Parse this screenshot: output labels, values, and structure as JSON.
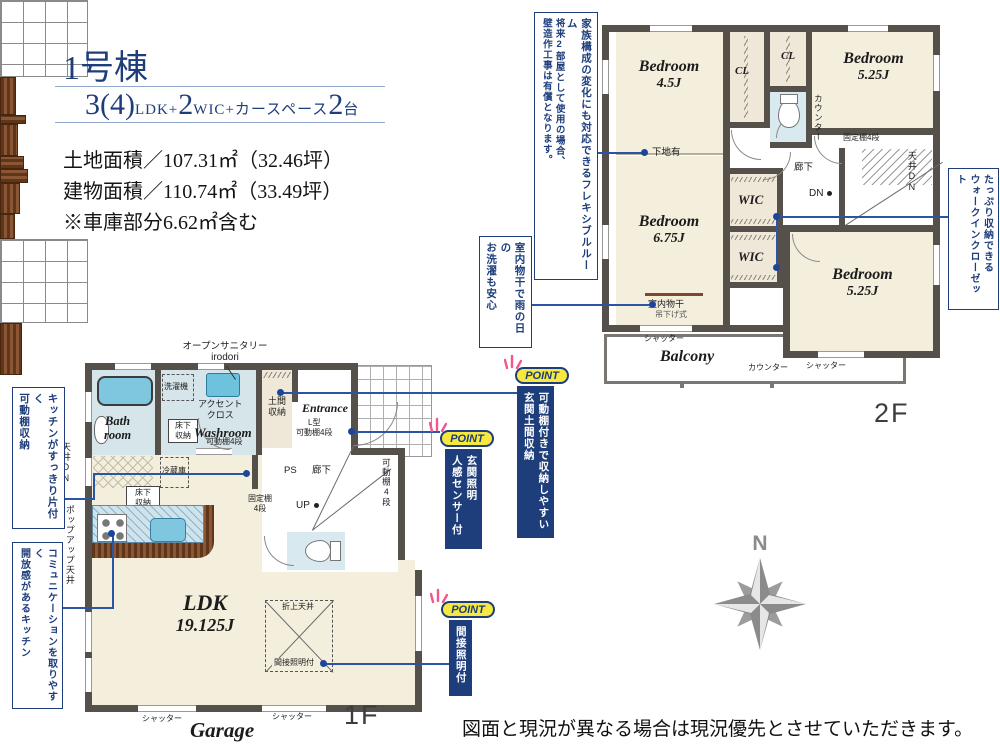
{
  "colors": {
    "accent": "#1d3d7b",
    "connector": "#2a55a5",
    "floor_beige": "#f4eedd",
    "wall": "#55504a",
    "water_blue": "#7fc6df",
    "point_yellow": "#f6e83e",
    "sparkle_pink": "#f2568c"
  },
  "title": {
    "name": "1号棟",
    "n1": "3(4)",
    "u1": "LDK+",
    "n2": "2",
    "u2": "WIC+カースペース",
    "n3": "2",
    "u3": "台",
    "land": "土地面積／107.31㎡（32.46坪）",
    "bldg": "建物面積／110.74㎡（33.49坪）",
    "note": "※車庫部分6.62㎡含む"
  },
  "f1": {
    "floor": "1F",
    "garage": "Garage",
    "ldk1": "LDK",
    "ldk2": "19.125J",
    "bath1": "Bath",
    "bath2": "room",
    "washroom": "Washroom",
    "entrance": "Entrance",
    "open_san1": "オープンサニタリー",
    "open_san2": "irodori",
    "sentakuki": "洗濯機",
    "accent1": "アクセント",
    "accent2": "クロス",
    "yukashita1": "床下",
    "yukashita2": "収納",
    "kadou4": "可動棚4段",
    "doma1": "土間",
    "doma2": "収納",
    "ltype1": "L型",
    "ltype2": "可動棚4段",
    "reizo": "冷蔵庫",
    "ps": "PS",
    "rouka": "廊下",
    "kotei1": "固定棚",
    "kotei2": "4段",
    "up": "UP",
    "kadou4r": "可動棚4段",
    "tenjodn": "天井DN",
    "popup": "ポップアップ天井",
    "oriage": "折上天井",
    "kansetsu": "間接照明付",
    "shutter": "シャッター"
  },
  "f2": {
    "floor": "2F",
    "bedroom": "Bedroom",
    "s45": "4.5J",
    "s675": "6.75J",
    "s525": "5.25J",
    "cl": "CL",
    "wic": "WIC",
    "counter": "カウンター",
    "kotei": "固定棚4段",
    "tenjodn": "天井DN",
    "shitaji": "下地有",
    "rouka": "廊下",
    "dn": "DN",
    "mono1": "室内物干",
    "mono2": "吊下げ式",
    "balcony": "Balcony",
    "shutter": "シャッター"
  },
  "ann": {
    "flex1": "家族構成の変化にも対応できるフレキシブルルーム",
    "flex2": "将来2部屋として使用の場合、",
    "flex3": "壁造作工事は有償となります。",
    "mono1": "室内物干で雨の日の",
    "mono2": "お洗濯も安心",
    "wic1": "たっぷり収納できる",
    "wic2": "ウォークインクローゼット",
    "ks1": "キッチンがすっきり片付く",
    "ks2": "可動棚収納",
    "kc1": "コミュニケーションを取りやすく",
    "kc2": "開放感があるキッチン"
  },
  "points": {
    "badge": "POINT",
    "p1a": "可動棚付きで収納しやすい",
    "p1b": "玄関土間収納",
    "p2a": "玄関照明",
    "p2b": "人感センサー付",
    "p3a": "間接照明付"
  },
  "compass": {
    "n": "N"
  },
  "disclaimer": "図面と現況が異なる場合は現況優先とさせていただきます。"
}
